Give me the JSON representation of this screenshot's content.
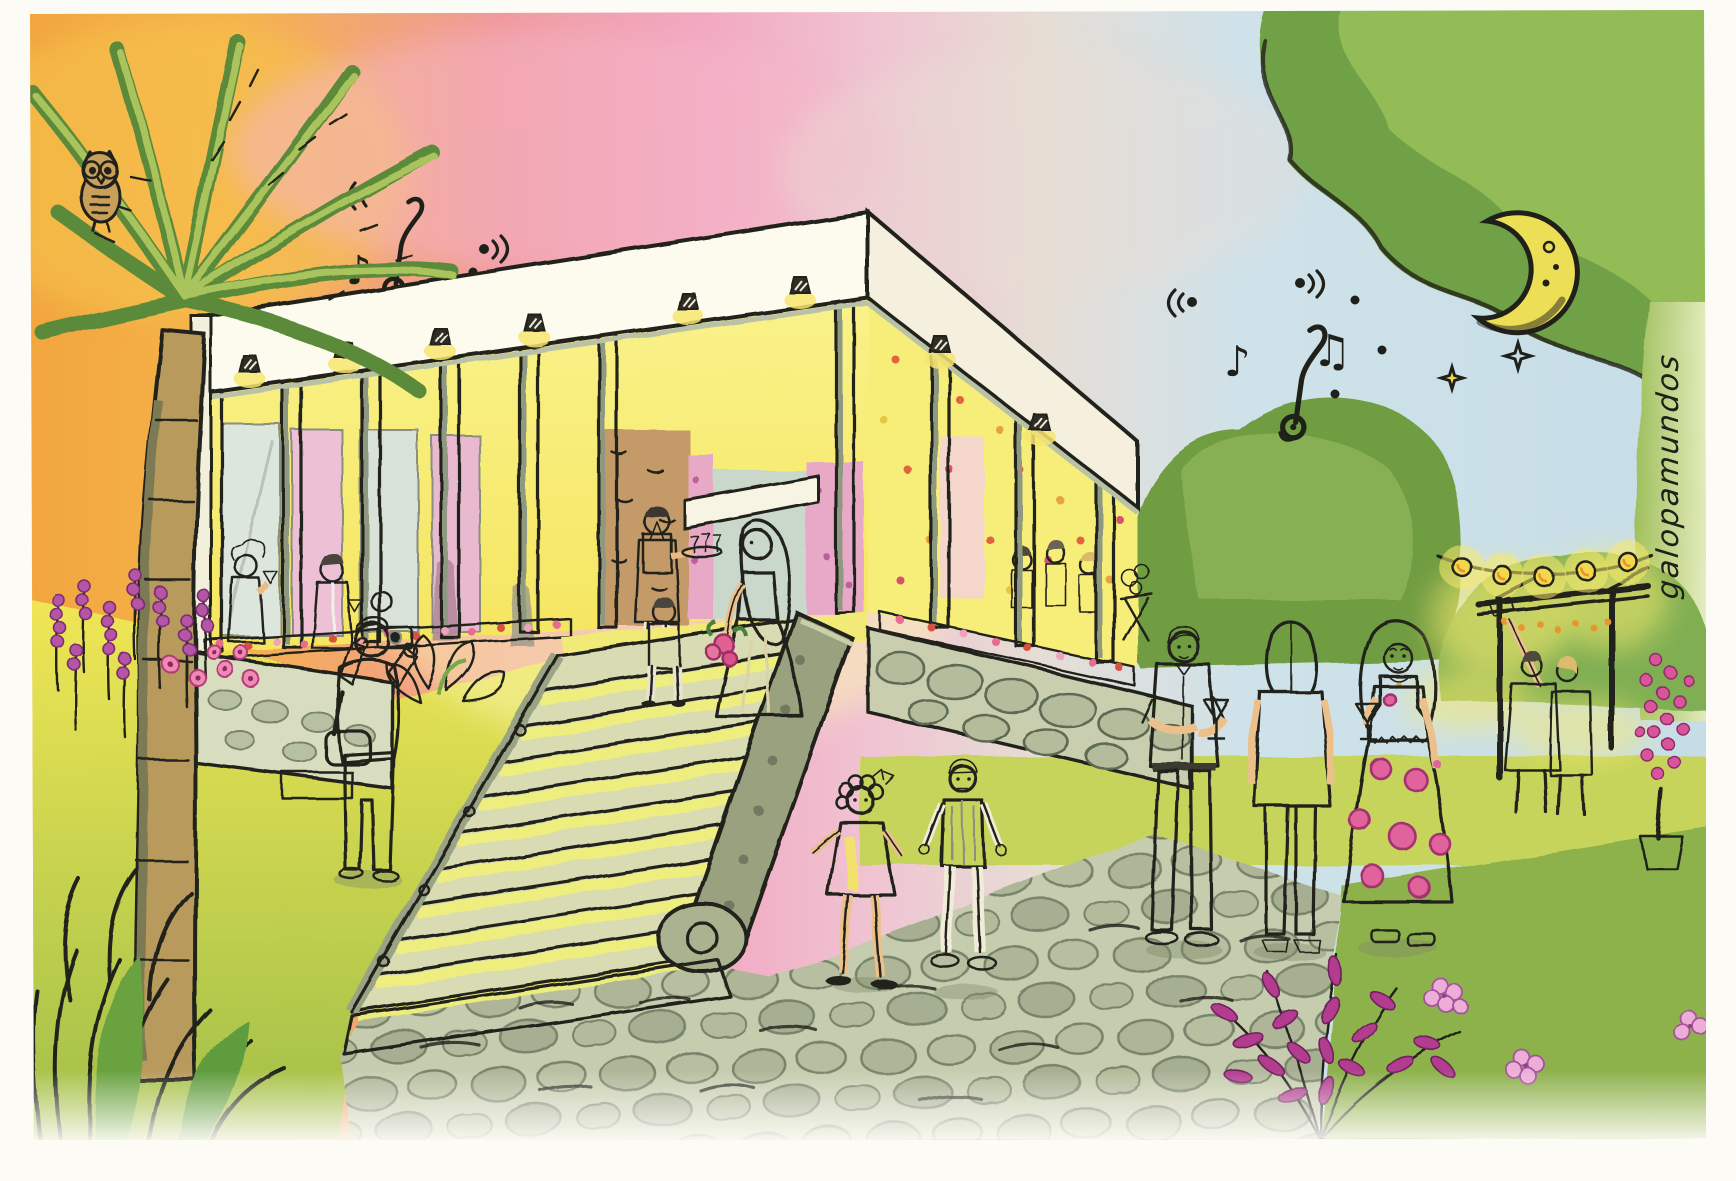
{
  "artwork": {
    "medium": "watercolor and ink illustration",
    "scene": "Evening wedding party at an open colonnaded pavilion: guests mingle on the lit veranda, a bride with a bouquet descends a grand stone staircase, a photographer shoots, two children cross a cobblestone path, three guests chat with wine glasses, a couple takes a selfie under a string-lit pergola; a palm tree with an owl stands left and a crescent moon with stars hangs in the dusk sky full of music notes.",
    "signature": "galopamundos",
    "sky": {
      "left": "sunset orange",
      "center": "pink",
      "right": "twilight blue"
    },
    "counts": {
      "stars": 2,
      "music_note_clusters": 2,
      "wall_sconces": 8,
      "string_light_bulbs": 5,
      "left_colonnade_columns": 7,
      "right_colonnade_columns": 3,
      "stair_steps": 11
    }
  },
  "icons": {
    "note_single": "♪",
    "note_beamed": "♫"
  },
  "people": {
    "bride": "white strapless gown, long hair, pink bouquet",
    "photographer": "grey hair, beige jacket, camera raised, shoulder bag",
    "waiter": "dark apron, tray of glasses",
    "porch_guests_left": 3,
    "porch_guests_right": 3,
    "man_at_stairs": "dark vest seen from behind",
    "flower_girl": "white dress, curly hair, pink bow",
    "boy": "grey vest, white trousers",
    "man_with_wine": "white shirt, grey trousers, glass of white wine",
    "woman_back_view": "blonde bob, grey top, white jeans, black heels",
    "woman_floral_dress": "long blonde hair, white dress with pink roses, glass of rose wine",
    "selfie_couple": "under pergola with raised phone"
  },
  "nature": {
    "owl": "perched in palm crown, top left",
    "palm_tree": "left side",
    "moon": "crescent with craters, top right",
    "flora": [
      "lavender spikes",
      "pink daisies",
      "magenta shrub",
      "hydrangea clusters",
      "pink blossom sapling in pot",
      "large leaves by staircase",
      "grass tufts"
    ],
    "ground": [
      "cobblestone path",
      "stone retaining walls",
      "grand staircase with volute ramp"
    ]
  },
  "palette": {
    "paper": "#fcfbf6",
    "ink": "#20201a",
    "sky_orange": "#f3a843",
    "sky_pink": "#f1a7c0",
    "sky_blue": "#cbe1e9",
    "glow_yellow": "#f8ef6e",
    "building_white": "#fbf8ea",
    "column_yellow": "#f3e96d",
    "foliage_dark": "#4f7c38",
    "foliage_mid": "#7fae52",
    "foliage_light": "#aac464",
    "stone_green": "#a8b08d",
    "cobble": "#c3caad",
    "wall_pink": "#e9a8c4",
    "stone_tan": "#c49a68",
    "blossom_pink": "#e4679a",
    "magenta": "#b23c8f",
    "moon_yellow": "#ecdf56",
    "skin": "#e9bc85"
  }
}
